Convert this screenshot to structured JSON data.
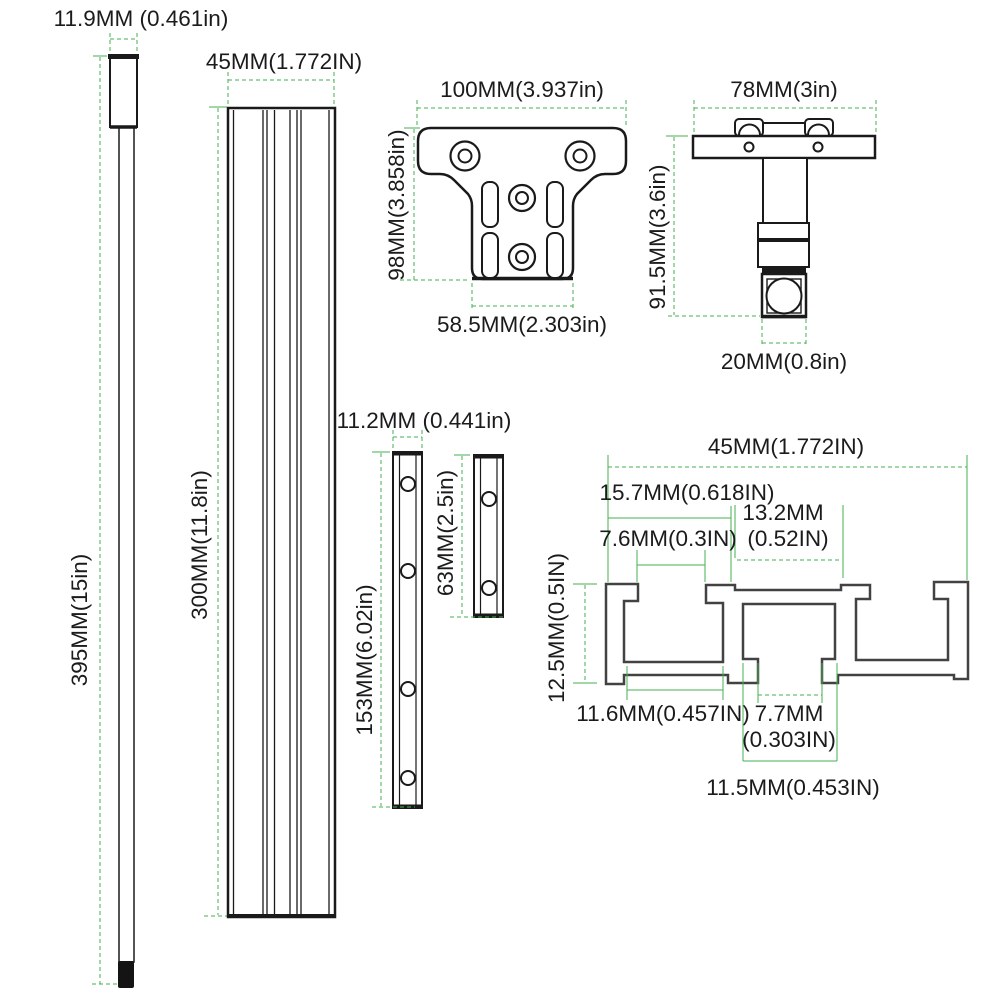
{
  "title": "T-track hardware kit dimension diagram",
  "colors": {
    "dimension_green": "#44b24f",
    "outline_black": "#1a1a1a",
    "profile_gray": "#424242"
  },
  "parts": {
    "rod": {
      "width_label": "11.9MM (0.461in)",
      "length_label": "395MM(15in)"
    },
    "track": {
      "width_label": "45MM(1.772IN)",
      "length_label": "300MM(11.8in)"
    },
    "bracket": {
      "width_label": "100MM(3.937in)",
      "height_label": "98MM(3.858in)",
      "base_label": "58.5MM(2.303in)"
    },
    "clamp": {
      "width_label": "78MM(3in)",
      "height_label": "91.5MM(3.6in)",
      "foot_label": "20MM(0.8in)"
    },
    "bars": {
      "width_label": "11.2MM (0.441in)",
      "long_label": "153MM(6.02in)",
      "short_label": "63MM(2.5in)"
    },
    "profile": {
      "overall_width": "45MM(1.772IN)",
      "left_web": "15.7MM(0.618IN)",
      "top_recess_line1": "13.2MM",
      "top_recess_line2": "(0.52IN)",
      "slot_opening": "7.6MM(0.3IN)",
      "height": "12.5MM(0.5IN)",
      "channel_width": "11.6MM(0.457IN)",
      "center_opening_line1": "7.7MM",
      "center_opening_line2": "(0.303IN)",
      "center_outer": "11.5MM(0.453IN)"
    }
  }
}
